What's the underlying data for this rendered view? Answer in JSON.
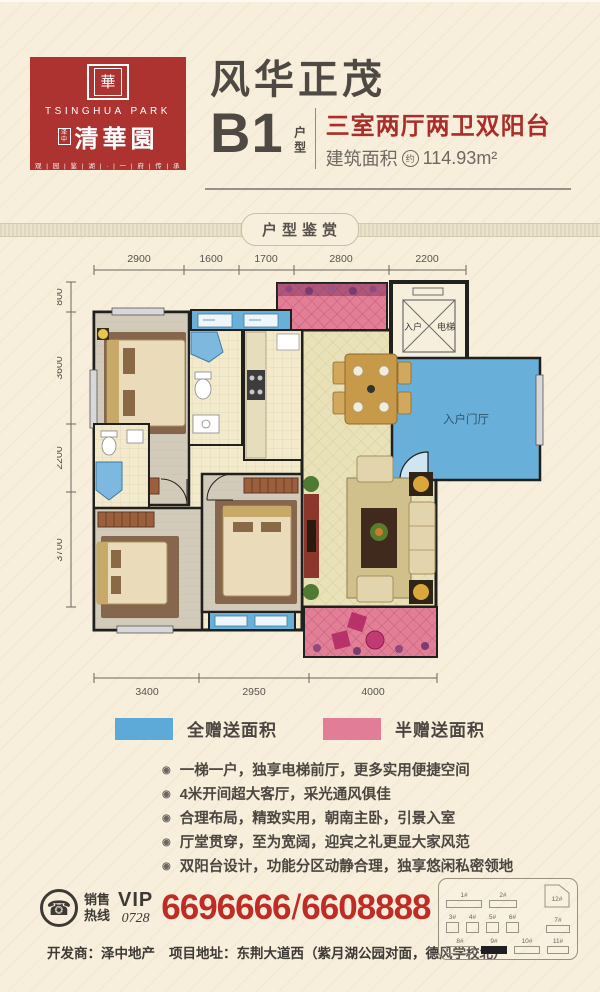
{
  "colors": {
    "bg": "#f7efdb",
    "brand_red": "#ad3330",
    "text_dark": "#4e4943",
    "highlight_red": "#ab2d2a",
    "phone_red": "#bf2c26",
    "full_gift_blue": "#5da9d8",
    "half_gift_pink": "#e27d97",
    "wall_black": "#20201e"
  },
  "icons": {
    "bullet": "◉",
    "phone": "☎",
    "seal": "華"
  },
  "logo": {
    "en": "TSINGHUA PARK",
    "mini": "泽中",
    "cn": "清華園",
    "tagline": "观 | 园 | 鉴 | 湖 | · | 一 | 府 | 传 | 承"
  },
  "header": {
    "title": "风华正茂",
    "unit": "B1",
    "unit_label": "户型",
    "spec_red": "三室两厅两卫双阳台",
    "area_label": "建筑面积",
    "area_approx": "约",
    "area_value": "114.93m²"
  },
  "banner": {
    "label": "户型鉴赏"
  },
  "plan": {
    "dims": {
      "top": [
        "2900",
        "1600",
        "1700",
        "2800",
        "2200"
      ],
      "left": [
        "800",
        "3600",
        "2200",
        "3700"
      ],
      "bottom": [
        "3400",
        "2950",
        "4000"
      ]
    },
    "labels": {
      "elevator_left": "入户",
      "elevator_right": "电梯",
      "entry_hall": "入户门厅"
    }
  },
  "legend": {
    "full_label": "全赠送面积",
    "half_label": "半赠送面积"
  },
  "features": [
    "一梯一户，独享电梯前厅，更多实用便捷空间",
    "4米开间超大客厅，采光通风俱佳",
    "合理布局，精致实用，朝南主卧，引景入室",
    "厅堂贯穿，至为宽阔，迎宾之礼更显大家风范",
    "双阳台设计，功能分区动静合理，独享悠闲私密领地"
  ],
  "contact": {
    "hotline_1": "销售",
    "hotline_2": "热线",
    "vip": "VIP",
    "code": "0728",
    "phone_a": "6696666",
    "divider": "/",
    "phone_b": "6608888"
  },
  "footer": {
    "developer": "开发商：泽中地产",
    "address": "项目地址：东荆大道西（紫月湖公园对面，德风学校北）"
  },
  "siteplan": {
    "buildings": [
      "1#",
      "2#",
      "12#",
      "3#",
      "4#",
      "5#",
      "6#",
      "7#",
      "8#",
      "9#",
      "10#",
      "11#"
    ],
    "highlight": "9#"
  }
}
